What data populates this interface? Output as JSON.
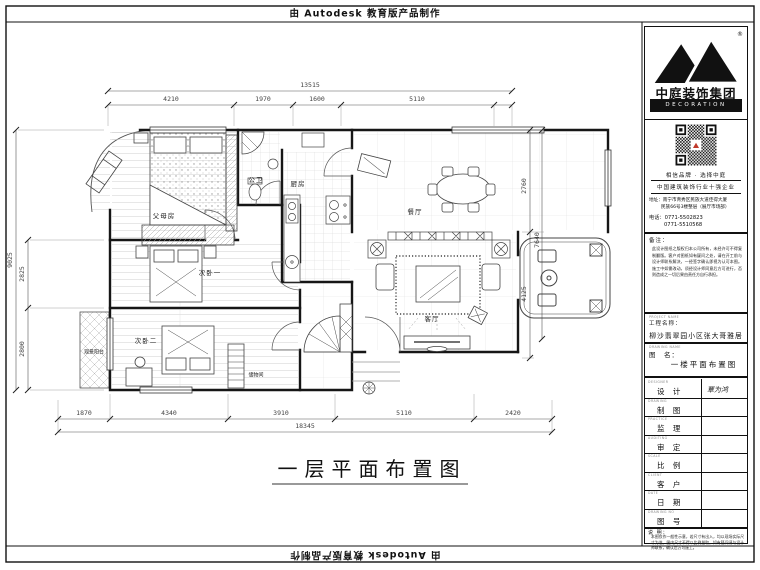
{
  "banner": {
    "top_text": "由 Autodesk 教育版产品制作",
    "bottom_text": "由 Autodesk 教育版产品制作"
  },
  "sheet_title": "一层平面布置图",
  "plan": {
    "rooms": {
      "parents": "父母房",
      "bath": "公卫",
      "kitchen": "厨房",
      "dining": "餐厅",
      "living": "客厅",
      "bed2": "次卧一",
      "bed3": "次卧二",
      "view_balcony": "观景阳台",
      "storage": "储物间"
    },
    "dims": {
      "top_total": "13515",
      "top": [
        "4210",
        "1970",
        "1600",
        "5110"
      ],
      "bottom": [
        "1870",
        "4340",
        "3910",
        "5110",
        "2420"
      ],
      "bottom_total": "18345",
      "left_total": "9025",
      "left": [
        "2825",
        "2800"
      ],
      "right": [
        "2760",
        "7640",
        "4125"
      ]
    }
  },
  "titleblock": {
    "brand": {
      "name": "中庭装饰集团",
      "sub": "DECORATION GROUP",
      "reg": "®"
    },
    "slogan1": "相信品牌 · 选择中庭",
    "slogan2": "中国建筑装饰行业十强企业",
    "address1": "地址：南宁市青秀区民族大道佳得大厦",
    "address2": "民族66号3楼整层（展厅市场部）",
    "phone1": "电话：0771-5502823",
    "phone2": "0771-5510568",
    "remark_label": "备注：",
    "remark_text": "此设计图纸之版权归本公司所有，未经许可不得复制翻版。客户对图纸如有疑问之处，请在开工前与设计师联系解决，一经签字确认即视为认可本图。施工中如需改动，须经设计师同意后方可进行，否则造成之一切后果由责任方自行承担。",
    "project_en": "PROJECT NAME",
    "project_label": "工程名称：",
    "project_name": "柳沙翡翠园小区张大哥雅居",
    "drawing_en": "DRAWING NAME",
    "drawing_label": "图　名：",
    "drawing_name": "一楼平面布置图",
    "rows": [
      {
        "en": "DESIGNER",
        "zh": "设 计",
        "value": "覃为鸿"
      },
      {
        "en": "DRAWING",
        "zh": "制 图",
        "value": ""
      },
      {
        "en": "PRACTICE",
        "zh": "监 理",
        "value": ""
      },
      {
        "en": "AUDITING",
        "zh": "审 定",
        "value": ""
      },
      {
        "en": "SCALE",
        "zh": "比 例",
        "value": ""
      },
      {
        "en": "CLIENT",
        "zh": "客 户",
        "value": ""
      },
      {
        "en": "DATE",
        "zh": "日 期",
        "value": ""
      },
      {
        "en": "DRAWING NO",
        "zh": "图 号",
        "value": ""
      }
    ],
    "note_label": "说 明：",
    "note_text": "本图仅作一般性示意，若尺寸有出入，均以现场实际尺寸为准。图内尺寸不得以比例量取，如有疑问请与设计师联系，确认后方可施工。"
  }
}
